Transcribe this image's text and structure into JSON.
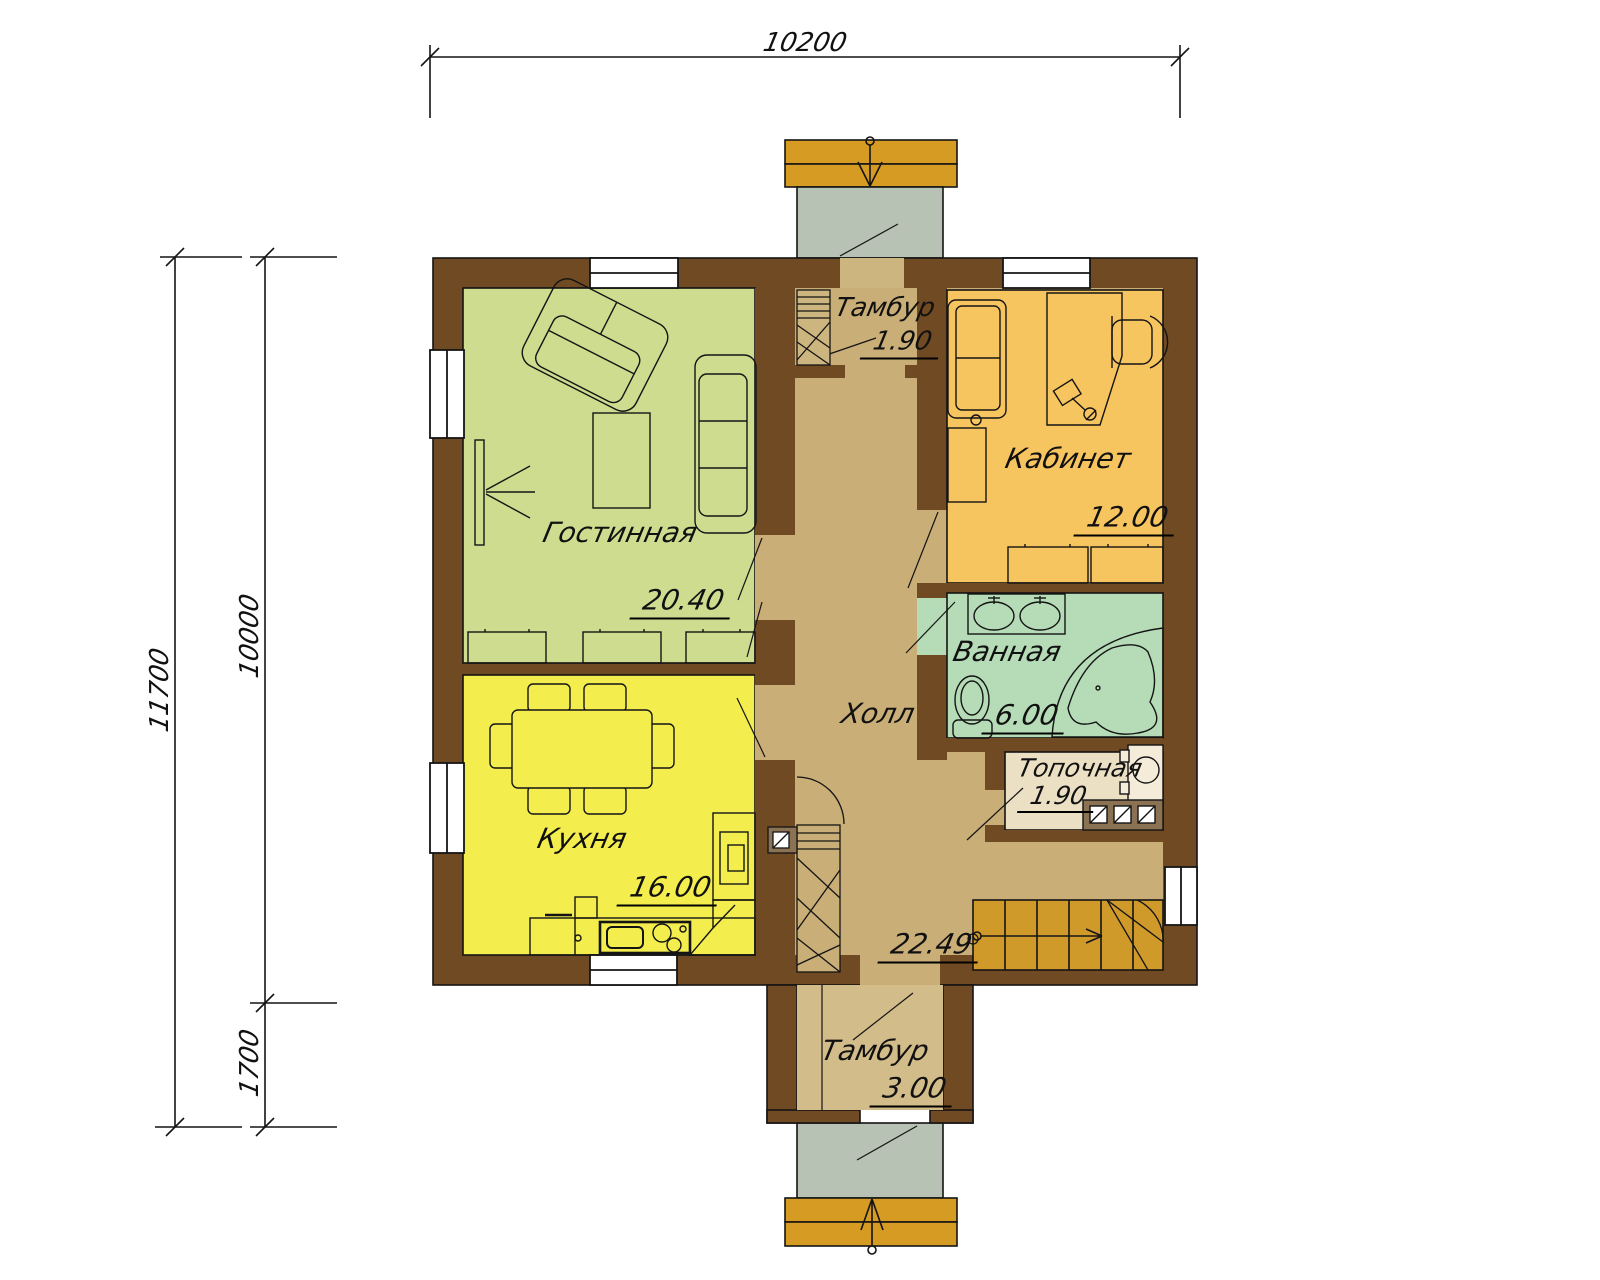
{
  "title": "Floor plan — first floor",
  "dimensions": {
    "top_width": "10200",
    "left_total_height": "11700",
    "left_main_height": "10000",
    "left_lower_height": "1700"
  },
  "rooms": {
    "living": {
      "name": "Гостинная",
      "area": "20.40"
    },
    "kitchen": {
      "name": "Кухня",
      "area": "16.00"
    },
    "vestibule_top": {
      "name": "Тамбур",
      "area": "1.90"
    },
    "office": {
      "name": "Кабинет",
      "area": "12.00"
    },
    "bathroom": {
      "name": "Ванная",
      "area": "6.00"
    },
    "boiler_room": {
      "name": "Топочная",
      "area": "1.90"
    },
    "hall": {
      "name": "Холл",
      "area": "22.49"
    },
    "vestibule_bottom": {
      "name": "Тамбур",
      "area": "3.00"
    }
  },
  "colors": {
    "wall": "#6f4a23",
    "living": "#cddc8f",
    "kitchen": "#f3ee4e",
    "office": "#f7c55f",
    "bathroom": "#b5dcb7",
    "hall": "#c9ae77",
    "vestibule": "#cdb57f",
    "vestibule2": "#d2bc89",
    "boiler": "#ece0c4",
    "porch": "#b7c2b4",
    "steps": "#d59b23",
    "stairs": "#d09a2b",
    "vent": "#8b7252",
    "line": "#141414"
  }
}
